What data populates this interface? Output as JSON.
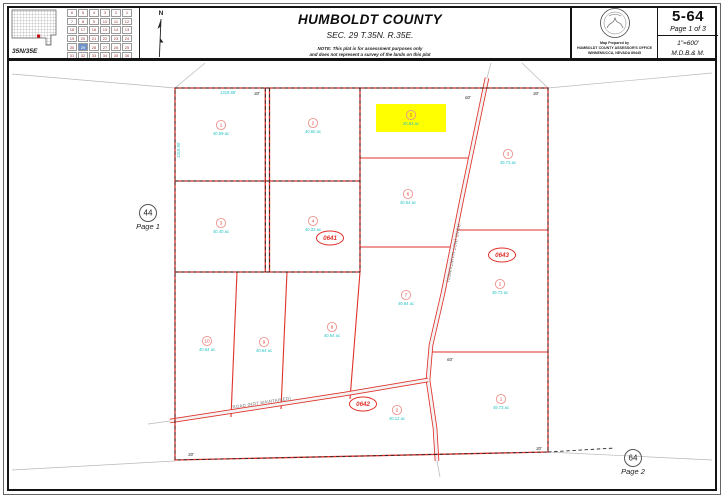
{
  "header": {
    "county": "HUMBOLDT COUNTY",
    "section_title": "SEC. 29 T.35N. R.35E.",
    "note_line1": "NOTE: This plat is for assessment purposes only",
    "note_line2": "and does not represent a survey of the lands on this plat",
    "township_label": "35N/35E",
    "north_label": "N"
  },
  "title_box": {
    "map_number": "5-64",
    "page_of": "Page 1 of 3",
    "scale": "1\"=600'",
    "meridian": "M.D.B.& M.",
    "prepared_line1": "Map Prepared by",
    "prepared_line2": "HUMBOLDT COUNTY ASSESSOR'S OFFICE",
    "prepared_line3": "WINNEMUCCA, NEVADA  89445"
  },
  "township_grid": {
    "rows": [
      [
        6,
        5,
        4,
        3,
        2,
        1
      ],
      [
        7,
        8,
        9,
        10,
        11,
        12
      ],
      [
        18,
        17,
        16,
        15,
        14,
        13
      ],
      [
        19,
        20,
        21,
        22,
        23,
        24
      ],
      [
        30,
        29,
        28,
        27,
        26,
        25
      ],
      [
        31,
        32,
        33,
        34,
        35,
        36
      ]
    ],
    "highlighted_section": 29
  },
  "blocks": [
    {
      "id": "0641"
    },
    {
      "id": "0642"
    },
    {
      "id": "0643"
    }
  ],
  "parcels": [
    {
      "block": "0641",
      "number": "1",
      "acreage": "40.59 ac",
      "highlighted": false
    },
    {
      "block": "0641",
      "number": "2",
      "acreage": "40.60 ac",
      "highlighted": false
    },
    {
      "block": "0641",
      "number": "3",
      "acreage": "40.40 ac",
      "highlighted": false
    },
    {
      "block": "0641",
      "number": "4",
      "acreage": "40.33 ac",
      "highlighted": false
    },
    {
      "block": "0641",
      "number": "5",
      "acreage": "40.64 ac",
      "highlighted": true
    },
    {
      "block": "0641",
      "number": "6",
      "acreage": "40.54 ac",
      "highlighted": false
    },
    {
      "block": "0641",
      "number": "7",
      "acreage": "40.64 ac",
      "highlighted": false
    },
    {
      "block": "0641",
      "number": "8",
      "acreage": "40.64 ac",
      "highlighted": false
    },
    {
      "block": "0641",
      "number": "9",
      "acreage": "40.64 ac",
      "highlighted": false
    },
    {
      "block": "0641",
      "number": "10",
      "acreage": "40.64 ac",
      "highlighted": false
    },
    {
      "block": "0642",
      "number": "2",
      "acreage": "40.12 ac",
      "highlighted": false
    },
    {
      "block": "0643",
      "number": "3",
      "acreage": "49.73 ac",
      "highlighted": false
    },
    {
      "block": "0643",
      "number": "2",
      "acreage": "49.73 ac",
      "highlighted": false
    },
    {
      "block": "0643",
      "number": "1",
      "acreage": "49.73 ac",
      "highlighted": false
    }
  ],
  "roads": [
    {
      "name": "ROAD (NOT MAINTAINED)"
    },
    {
      "name": "ROAD (NOT MAINTAINED)"
    }
  ],
  "annotations": {
    "offset_30": "30'",
    "offset_60": "60'",
    "dim_top": "1319.86'",
    "dim_left": "1319.80'"
  },
  "page_refs": [
    {
      "number": "44",
      "label": "Page 1"
    },
    {
      "number": "64",
      "label": "Page 2"
    }
  ],
  "colors": {
    "parcel_line": "#e0312a",
    "acreage_text": "#25c3c3",
    "highlight": "#ffff00",
    "dash": "#2a2a2a"
  }
}
